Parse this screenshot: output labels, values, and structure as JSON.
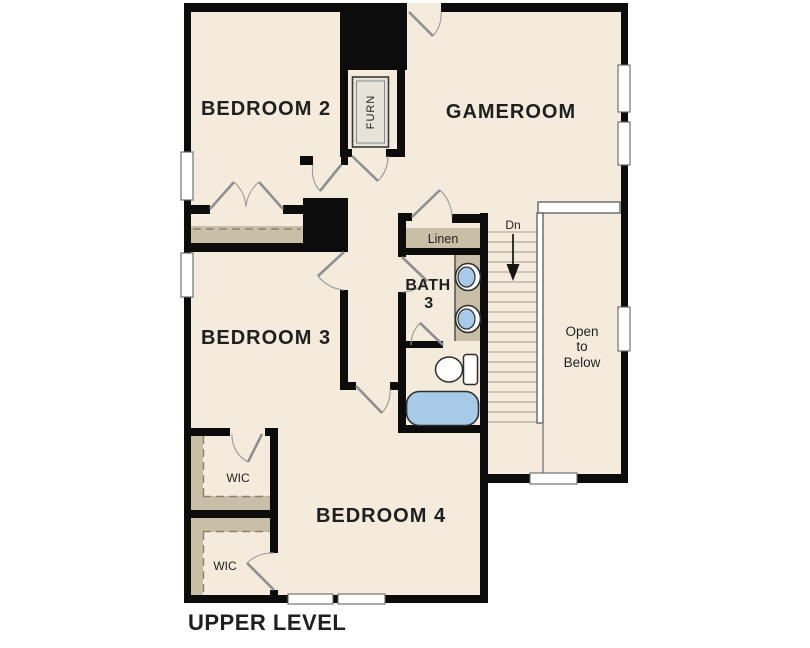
{
  "plan_title": "UPPER LEVEL",
  "labels": {
    "bedroom2": "BEDROOM 2",
    "gameroom": "GAMEROOM",
    "bedroom3": "BEDROOM 3",
    "bedroom4": "BEDROOM 4",
    "bath_line1": "BATH",
    "bath_line2": "3",
    "linen": "Linen",
    "wic_upper": "WIC",
    "wic_lower": "WIC",
    "furnace": "FURN",
    "stair_direction": "Dn",
    "open_below_line1": "Open",
    "open_below_line2": "to",
    "open_below_line3": "Below"
  },
  "colors": {
    "background": "#ffffff",
    "floor": "#f4ebdd",
    "wall": "#0c0c0c",
    "casework_tan": "#c9bfa6",
    "fixture_blue": "#a8cae9"
  }
}
